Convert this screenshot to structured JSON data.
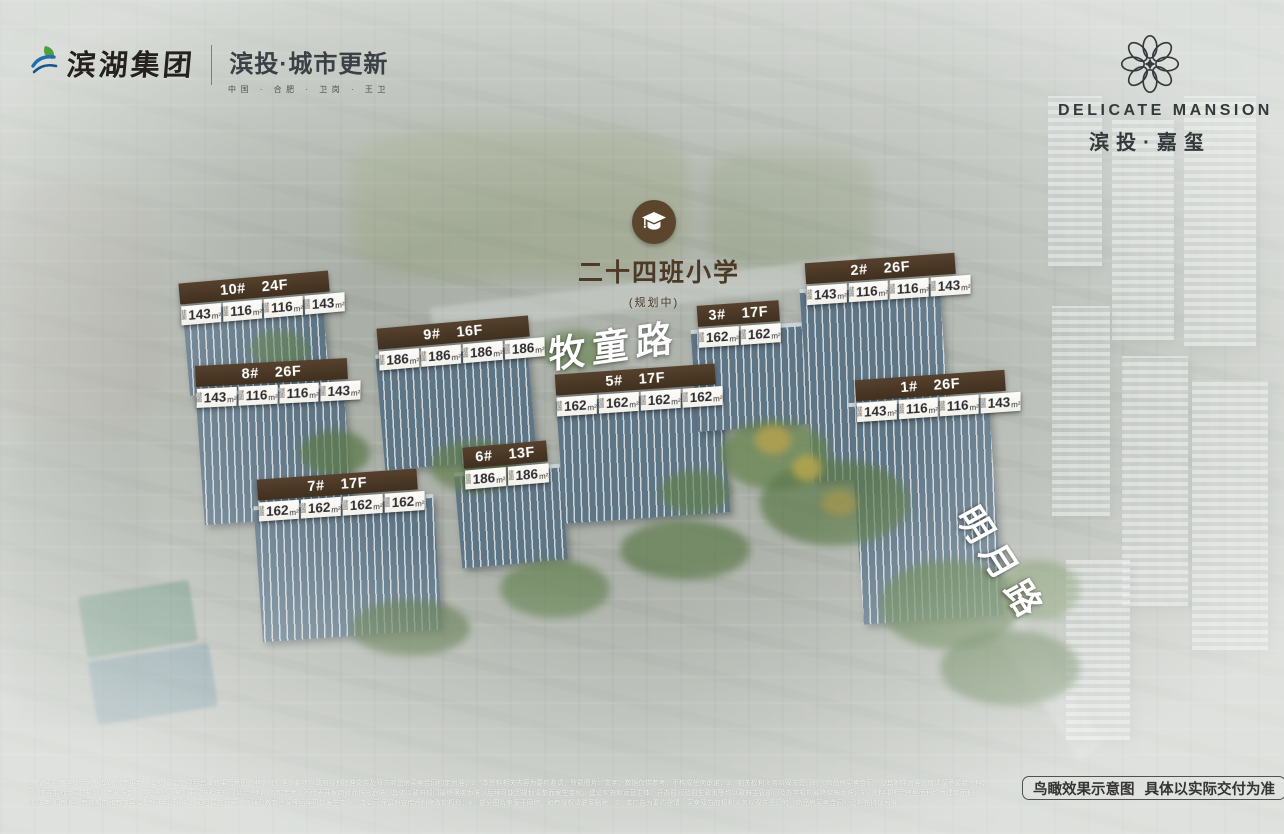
{
  "brand_header": {
    "group_name": "滨湖集团",
    "group_logo_icon": "binhu-leaf-logo",
    "division_title": "滨投·城市更新",
    "division_subtitle": "中国 · 合肥 · 卫岗 · 王卫"
  },
  "project_logo": {
    "icon": "petal-flower-logo",
    "name_en": "DELICATE MANSION",
    "name_cn": "滨投·嘉玺"
  },
  "school_marker": {
    "icon": "graduation-cap-icon",
    "label": "二十四班小学",
    "status": "(规划中)"
  },
  "roads": [
    {
      "name": "牧童路"
    },
    {
      "name": "明月路"
    }
  ],
  "unit_prefix": "建面",
  "unit_suffix": "m²",
  "buildings": [
    {
      "no": "10#",
      "floors": "24F",
      "units": [
        "143",
        "116",
        "116",
        "143"
      ]
    },
    {
      "no": "9#",
      "floors": "16F",
      "units": [
        "186",
        "186",
        "186",
        "186"
      ]
    },
    {
      "no": "2#",
      "floors": "26F",
      "units": [
        "143",
        "116",
        "116",
        "143"
      ]
    },
    {
      "no": "3#",
      "floors": "17F",
      "units": [
        "162",
        "162"
      ]
    },
    {
      "no": "8#",
      "floors": "26F",
      "units": [
        "143",
        "116",
        "116",
        "143"
      ]
    },
    {
      "no": "5#",
      "floors": "17F",
      "units": [
        "162",
        "162",
        "162",
        "162"
      ]
    },
    {
      "no": "1#",
      "floors": "26F",
      "units": [
        "143",
        "116",
        "116",
        "143"
      ]
    },
    {
      "no": "6#",
      "floors": "13F",
      "units": [
        "186",
        "186"
      ]
    },
    {
      "no": "7#",
      "floors": "17F",
      "units": [
        "162",
        "162",
        "162",
        "162"
      ]
    }
  ],
  "footer": {
    "view_note_1": "鸟瞰效果示意图",
    "view_note_2": "具体以实际交付为准",
    "disclaimer_lines": [
      "1、该项目广告所示为「滨湖·城市更新｜滨投·嘉玺」项目鸟瞰效果示意图，非交付标准，最终以政府规划批准文件及双方商品房买卖合同约定为准；2、本资料相关内容为要约邀请，所载图片、文字、数据仅供参考，不构成任何承诺；3、相关权利义务以双方签订的《商品房买卖合同》及其附件为准，敬请留意最新资料；",
      "4、广告中所示周边规划、市政配套、学校等信息来源于政府相关部门公示资料，仅供参考，不代表开发商对此作出承诺，具体以政府部门最终落实为准；后续可能因规划调整而发生变化，建设实施和运营主体、开办时间及招生政策等均以政府主管部门及办学机构最终公布为准；5、资料中所示户型面积均为建筑面积，",
      "2025年3月制作，有效期内如有内容调整恕不另行通知，项目周边环境、交通及教育资源等后续可能发生变化，本公司保留对宣传资料修改的权利；6、部分图片来源于网络，如有侵权请联系删除；7、本广告为要约邀请，买卖双方的权利义务以双方签订的《商品房买卖合同》及补充协议为准。"
    ]
  },
  "colors": {
    "label_brown": "#40301f",
    "school_brown": "#5b462d",
    "tag_background": "#f3f1ea",
    "road_text": "#ffffff",
    "logo_dark": "#34393c"
  }
}
